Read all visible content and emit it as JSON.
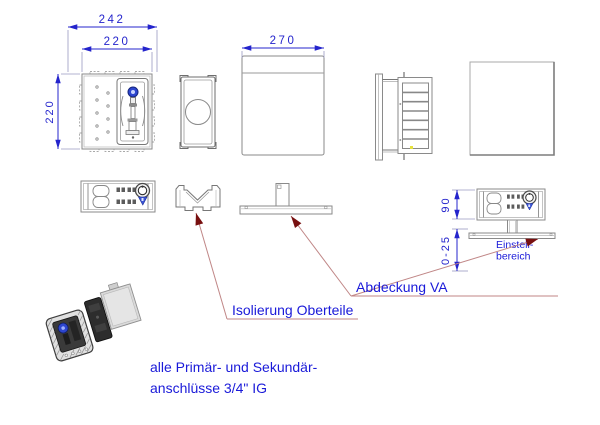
{
  "drawing": {
    "dimensions": {
      "front_outer_width": "242",
      "front_inner_width": "220",
      "front_height": "220",
      "cover_width": "270",
      "box_depth": "90",
      "adjustment_range": "0-25"
    },
    "callouts": {
      "adjustment_label": [
        "Einstell-",
        "bereich"
      ],
      "cover_label": "Abdeckung VA",
      "insulation_label": "Isolierung Oberteile",
      "note": [
        "alle Primär- und Sekundär-",
        "anschlüsse 3/4\" IG"
      ]
    },
    "colors": {
      "dimension_blue": "#2424cc",
      "label_blue": "#1a1ad9",
      "outline_gray": "#8a8a8a",
      "leader_red": "#c08686",
      "arrow_dark_red": "#781010",
      "valve_blue": "#2d46cf"
    }
  }
}
